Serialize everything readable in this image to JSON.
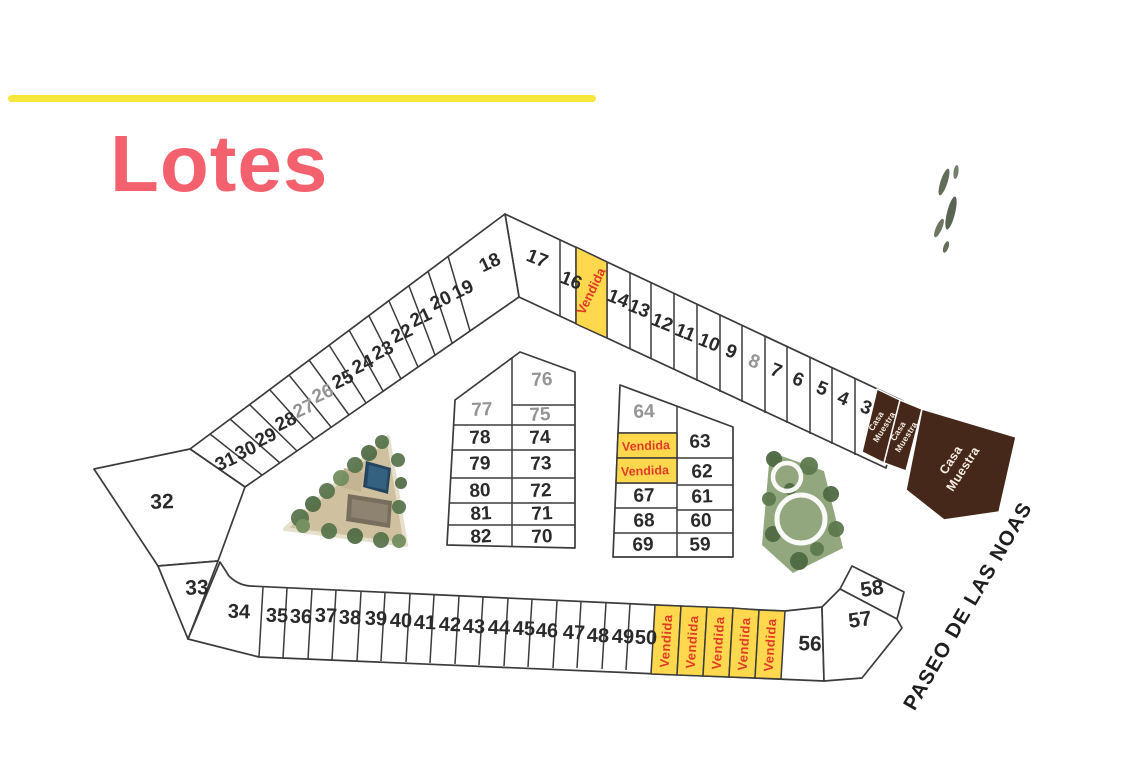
{
  "header": {
    "title": "Lotes"
  },
  "labels": {
    "sold": "Vendida",
    "model_home_line1": "Casa",
    "model_home_line2": "Muestra",
    "street": "PASEO DE LAS NOAS"
  },
  "colors": {
    "title_accent": "#f4616e",
    "rule_accent": "#f7e73b",
    "sold_fill": "#ffd84d",
    "sold_text": "#e23b28",
    "model_home_fill": "#46281a",
    "plan_line": "#3b3b3b",
    "lot_number": "#2a2a2a",
    "lot_number_muted": "#949494"
  },
  "lots": {
    "top_right_strip": [
      "17",
      "16",
      "14",
      "13",
      "12",
      "11",
      "10",
      "9",
      "8",
      "7",
      "6",
      "5",
      "4",
      "3"
    ],
    "top_left_strip": [
      "18",
      "19",
      "20",
      "21",
      "22",
      "23",
      "24",
      "25",
      "26",
      "27",
      "28",
      "29",
      "30",
      "31"
    ],
    "west_lots": [
      "32",
      "33"
    ],
    "bottom_strip": [
      "34",
      "35",
      "36",
      "37",
      "38",
      "39",
      "40",
      "41",
      "42",
      "43",
      "44",
      "45",
      "46",
      "47",
      "48",
      "49",
      "50",
      "56"
    ],
    "corner_lots": [
      "57",
      "58"
    ],
    "block_a_left": [
      "77",
      "78",
      "79",
      "80",
      "81",
      "82"
    ],
    "block_a_right": [
      "76",
      "75",
      "74",
      "73",
      "72",
      "71",
      "70"
    ],
    "block_b_left": [
      "64",
      "67",
      "68",
      "69"
    ],
    "block_b_right": [
      "63",
      "62",
      "61",
      "60",
      "59"
    ]
  },
  "sold_cell_counts": {
    "top_right_strip": 1,
    "block_b": 2,
    "bottom_strip": 5
  },
  "model_home_cell_count": 3,
  "muted_lot_numbers": [
    "8",
    "26",
    "27",
    "64",
    "75",
    "76",
    "77"
  ]
}
